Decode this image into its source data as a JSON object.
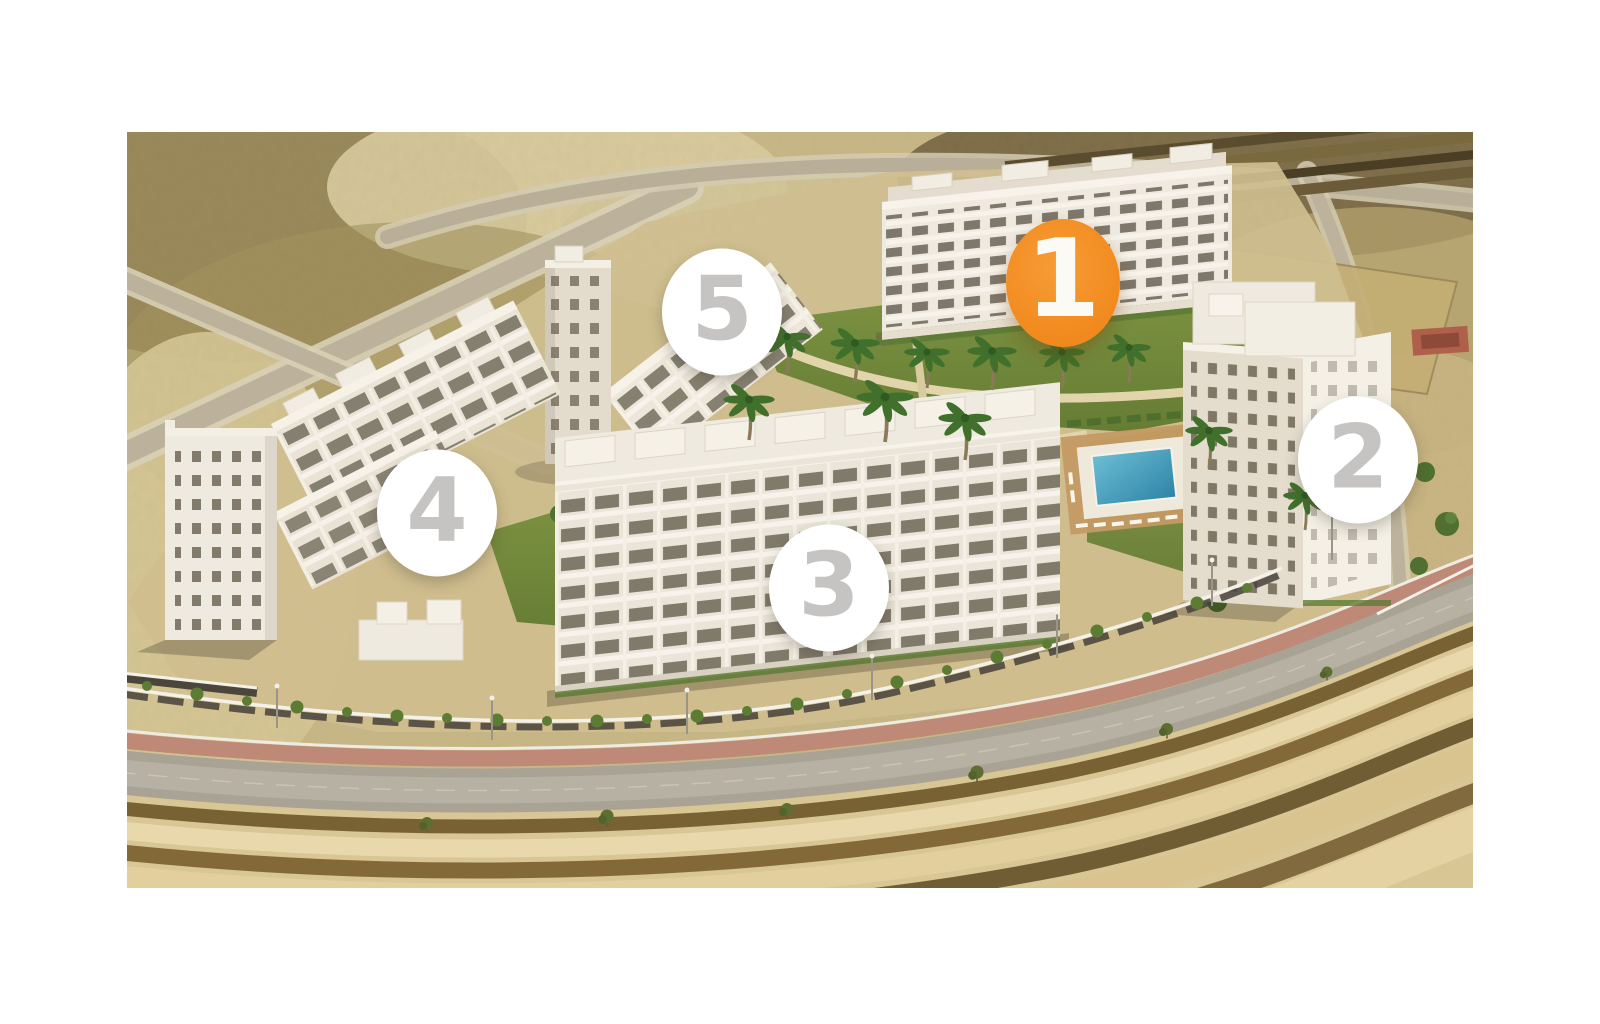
{
  "image": {
    "description": "Aerial 3D render of a five-building white residential apartment complex with central landscaped courtyard, two swimming pools, palm trees, a curved perimeter road with terraced earth embankments below, and surrounding sandy terrain with dirt roads",
    "width_px": 1346,
    "height_px": 756
  },
  "markers": [
    {
      "label": "1",
      "variant": "active",
      "x_pct": 69.54,
      "y_pct": 19.97
    },
    {
      "label": "2",
      "variant": "default",
      "x_pct": 91.46,
      "y_pct": 43.39
    },
    {
      "label": "3",
      "variant": "default",
      "x_pct": 52.15,
      "y_pct": 60.32
    },
    {
      "label": "4",
      "variant": "default",
      "x_pct": 23.03,
      "y_pct": 50.4
    },
    {
      "label": "5",
      "variant": "default",
      "x_pct": 44.21,
      "y_pct": 23.81
    }
  ],
  "colors": {
    "accent_orange": "#F18A1E",
    "marker_white": "#FFFFFF",
    "digit_gray": "#C5C4C2",
    "active_digit": "#FCFAF4"
  }
}
